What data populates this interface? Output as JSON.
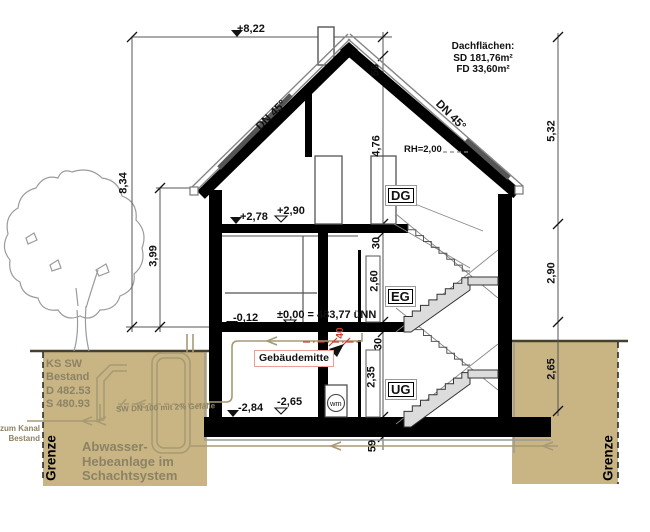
{
  "levels": {
    "ridge": "+8,22",
    "dg_finish": "+2,78",
    "dg_raw": "+2,90",
    "eg_finish": "-0,12",
    "eg_raw": "±0,00 = 483,77 üNN",
    "ug_finish": "-2,84",
    "ug_raw": "-2,65"
  },
  "roof": {
    "pitch_left": "DN 45°",
    "pitch_right": "DN 45°",
    "note": {
      "title": "Dachflächen:",
      "sd": "SD 181,76m²",
      "fd": "FD 33,60m²"
    },
    "headroom": "RH=2,00"
  },
  "storeys": {
    "attic": "DG",
    "ground": "EG",
    "basement": "UG"
  },
  "dimensions": {
    "left_total": "8,34",
    "left_eaves": "3,99",
    "right_roof": "5,32",
    "right_eg": "2,90",
    "right_ug": "2,65",
    "ridge_offset": "56",
    "attic_height": "4,76",
    "slab_dg": "30",
    "eg_height": "2,60",
    "slab_eg": "30",
    "ug_height": "2,35",
    "base_slab": "59",
    "center_offset": "40"
  },
  "annotations": {
    "building_center": "Gebäudemitte",
    "washer": "wm"
  },
  "site": {
    "shaft_existing": {
      "l1": "KS SW",
      "l2": "Bestand",
      "l3": "D 482.53",
      "l4": "S 480.93"
    },
    "sewer_pipe": "SW DN 100 mit 2% Gefälle",
    "to_canal": {
      "l1": "zum Kanal",
      "l2": "Bestand"
    },
    "lifting_station": {
      "l1": "Abwasser-",
      "l2": "Hebeanlage im",
      "l3": "Schachtsystem"
    },
    "boundary_left": "Grenze",
    "boundary_right": "Grenze"
  },
  "colors": {
    "ground": "#c9b584",
    "site_text": "#8c8264",
    "red": "#d63a2f",
    "stair_fill": "#dcdcdc",
    "pipe": "#a79a74"
  }
}
